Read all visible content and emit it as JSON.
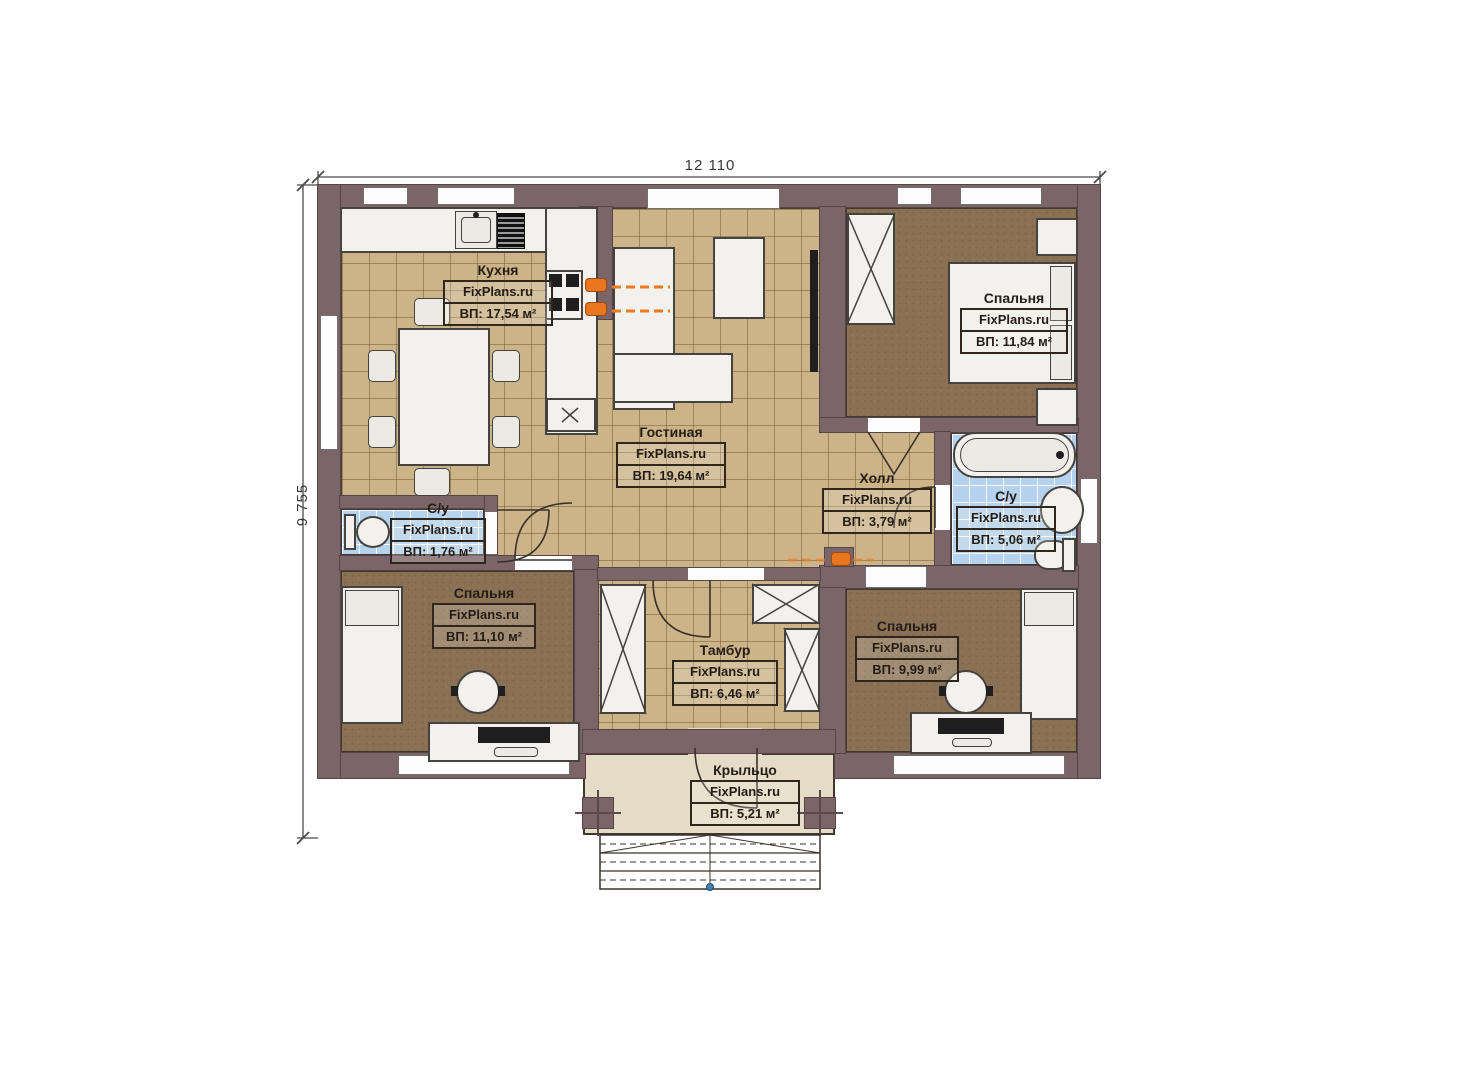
{
  "plan": {
    "dim_width": "12 110",
    "dim_height": "9 755",
    "brand": "FixPlans.ru",
    "rooms": [
      {
        "key": "kitchen",
        "name": "Кухня",
        "area": "ВП: 17,54 м²"
      },
      {
        "key": "living",
        "name": "Гостиная",
        "area": "ВП: 19,64 м²"
      },
      {
        "key": "bedroom-top-right",
        "name": "Спальня",
        "area": "ВП: 11,84 м²"
      },
      {
        "key": "hall",
        "name": "Холл",
        "area": "ВП: 3,79 м²"
      },
      {
        "key": "bathroom-right",
        "name": "С/у",
        "area": "ВП: 5,06 м²"
      },
      {
        "key": "bathroom-left",
        "name": "С/у",
        "area": "ВП: 1,76 м²"
      },
      {
        "key": "bedroom-bottom-left",
        "name": "Спальня",
        "area": "ВП: 11,10 м²"
      },
      {
        "key": "vestibule",
        "name": "Тамбур",
        "area": "ВП: 6,46 м²"
      },
      {
        "key": "bedroom-bottom-right",
        "name": "Спальня",
        "area": "ВП: 9,99 м²"
      },
      {
        "key": "porch",
        "name": "Крыльцо",
        "area": "ВП: 5,21 м²"
      }
    ],
    "colors": {
      "wall": "#7c6569",
      "floor_tile": "#ccb488",
      "floor_wood": "#8a7154",
      "floor_bath": "#b5d2ee",
      "floor_porch": "#e6dbc6",
      "accent_orange": "#e8761f"
    }
  }
}
